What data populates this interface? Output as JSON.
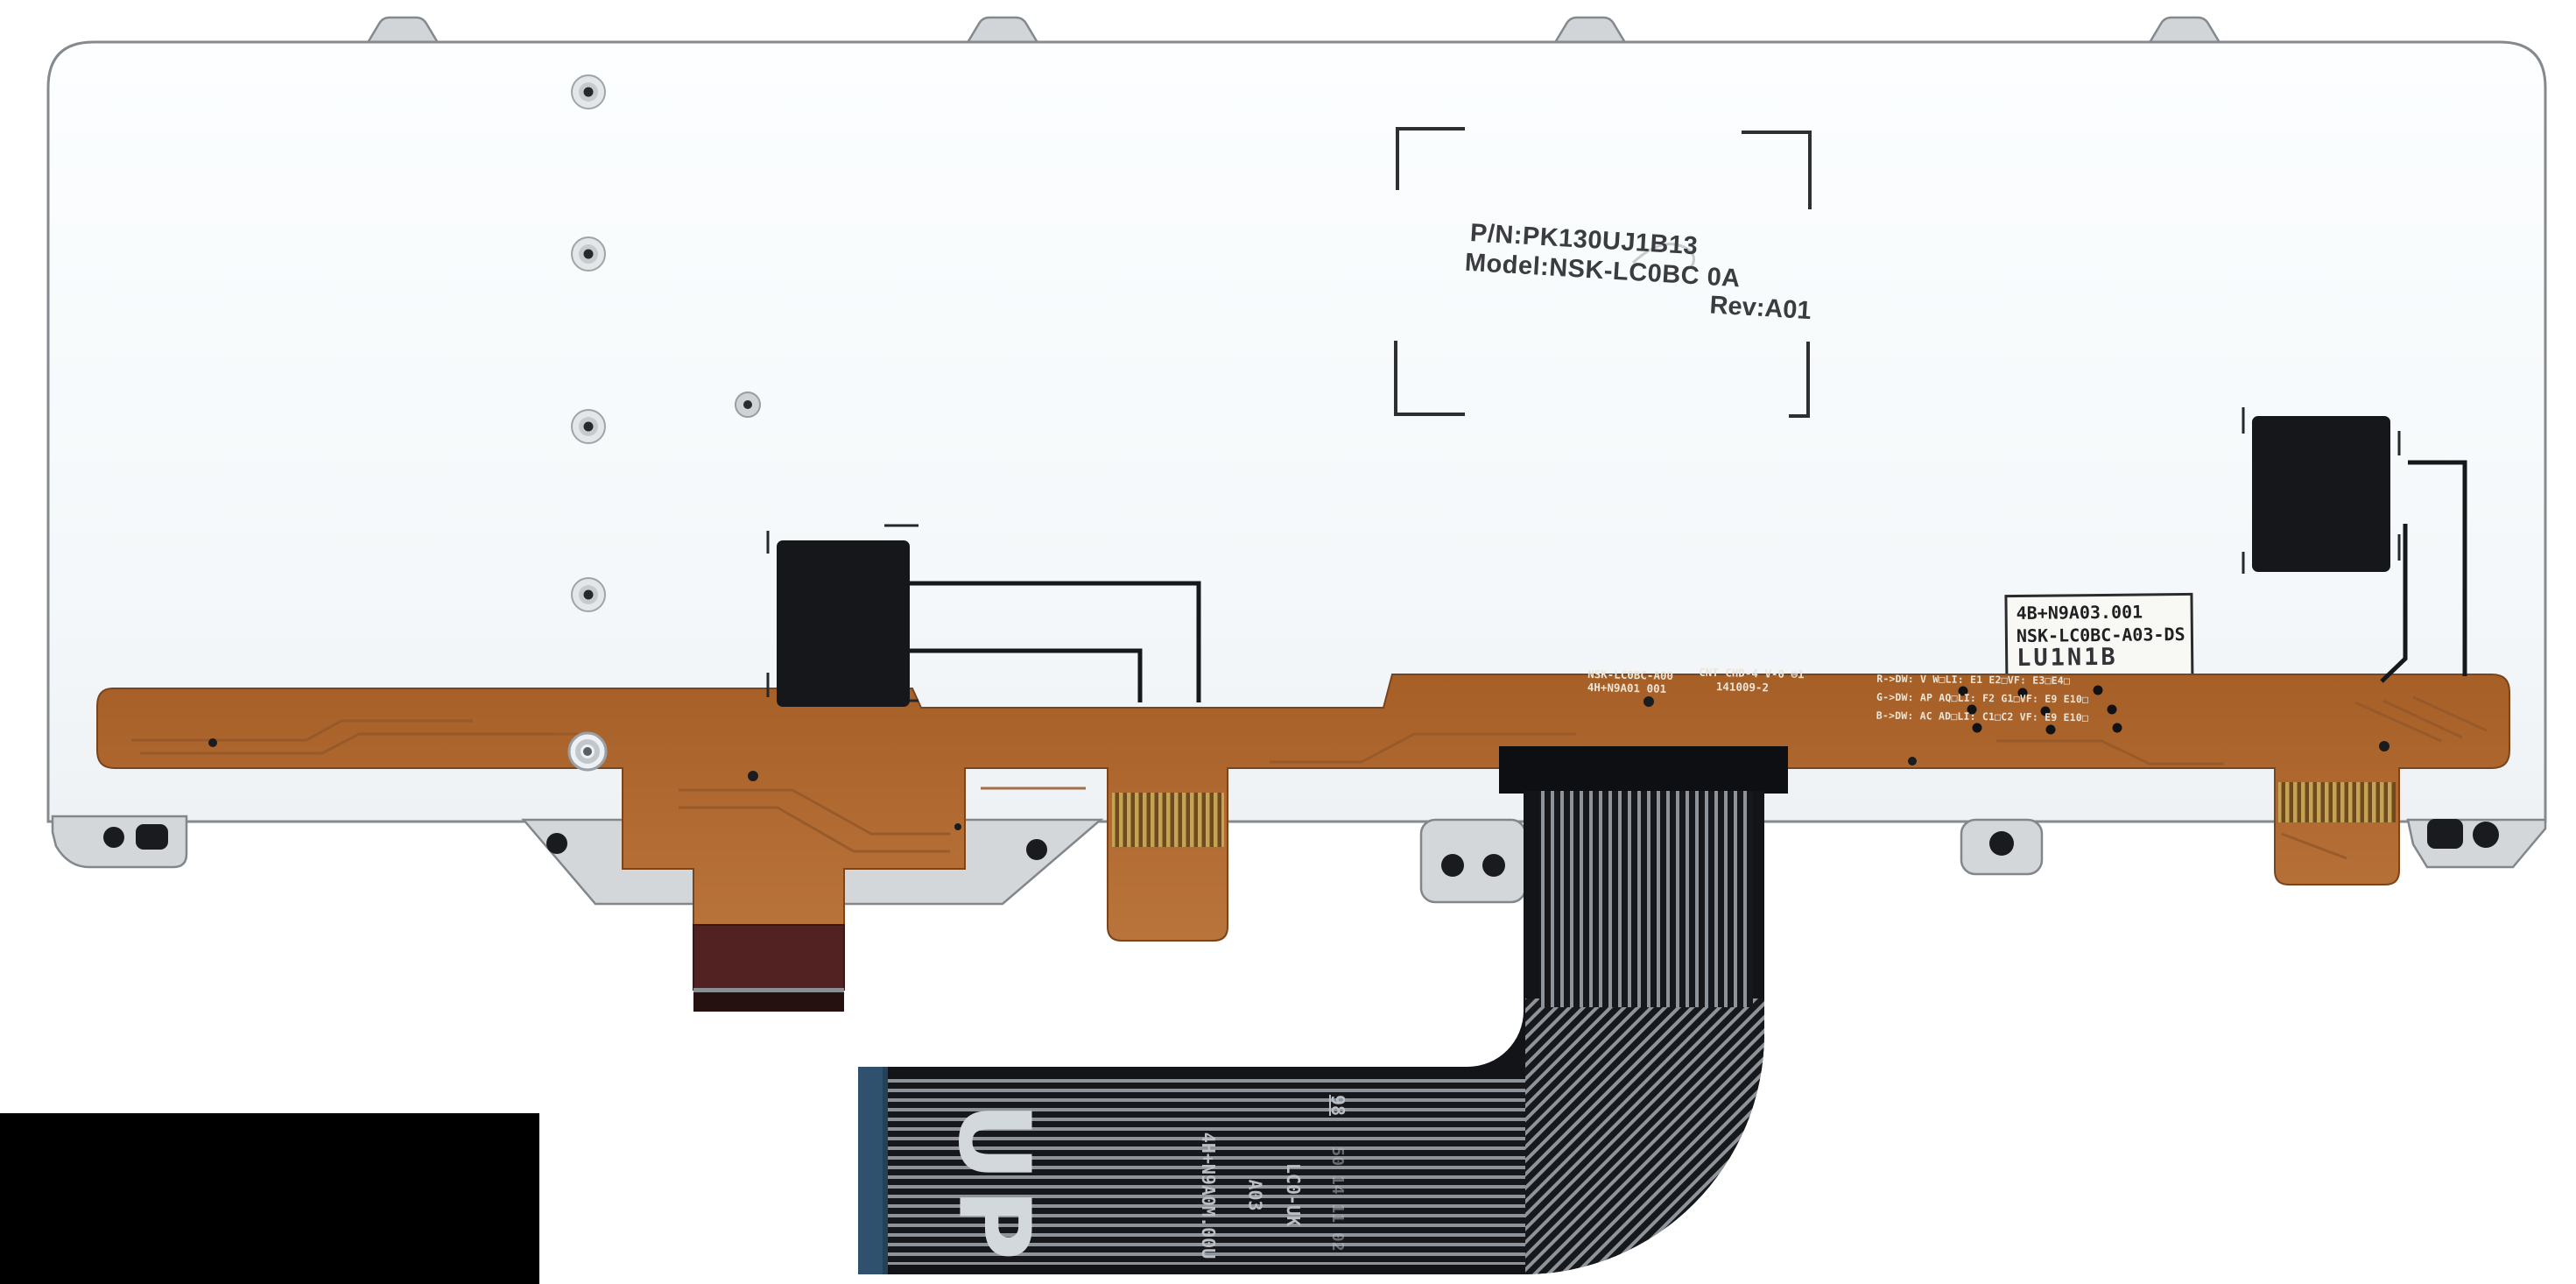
{
  "photo": {
    "subject": "Rear side of a laptop keyboard metal backplate with orange backlight flex circuit and black ribbon cable",
    "colors": {
      "background": "#ffffff",
      "plate": "#f6f9fb",
      "plate_edge": "#858a8f",
      "copper_flex": "#ae6830",
      "ribbon_black": "#131418",
      "ribbon_conductor": "#8e949a",
      "blue_stiffener": "#30516d",
      "maroon_stiffener": "#512221",
      "gold_fingers": "#c4a355",
      "censor_box": "#000000"
    },
    "stamp": {
      "pn": "P/N:PK130UJ1B13",
      "model": "Model:NSK-LC0BC  0A",
      "rev": "Rev:A01"
    },
    "sticker": {
      "line1": "4B+N9A03.001",
      "line2": "NSK-LC0BC-A03-DS",
      "line3_partial": "LU1N1B"
    },
    "flex": {
      "part1": "NSK-LC0BC-A00",
      "part2": "4H+N9A01 001",
      "spec1": "CNT CHD-4 V-0 ⊖1",
      "spec2": "141009-2",
      "rgb1": "R->DW: V W□LI: E1 E2□VF: E3□E4□",
      "rgb2": "G->DW: AP AQ□LI: F2 G1□VF: E9 E10□",
      "rgb3": "B->DW: AC AD□LI: C1□C2 VF: E9 E10□"
    },
    "ribbon": {
      "up": "UP",
      "code": "4H+N9A0M.00U",
      "rev": "A03",
      "variant": "LC0-UK",
      "num": "98",
      "date_faint": "50 14 11 02"
    }
  }
}
